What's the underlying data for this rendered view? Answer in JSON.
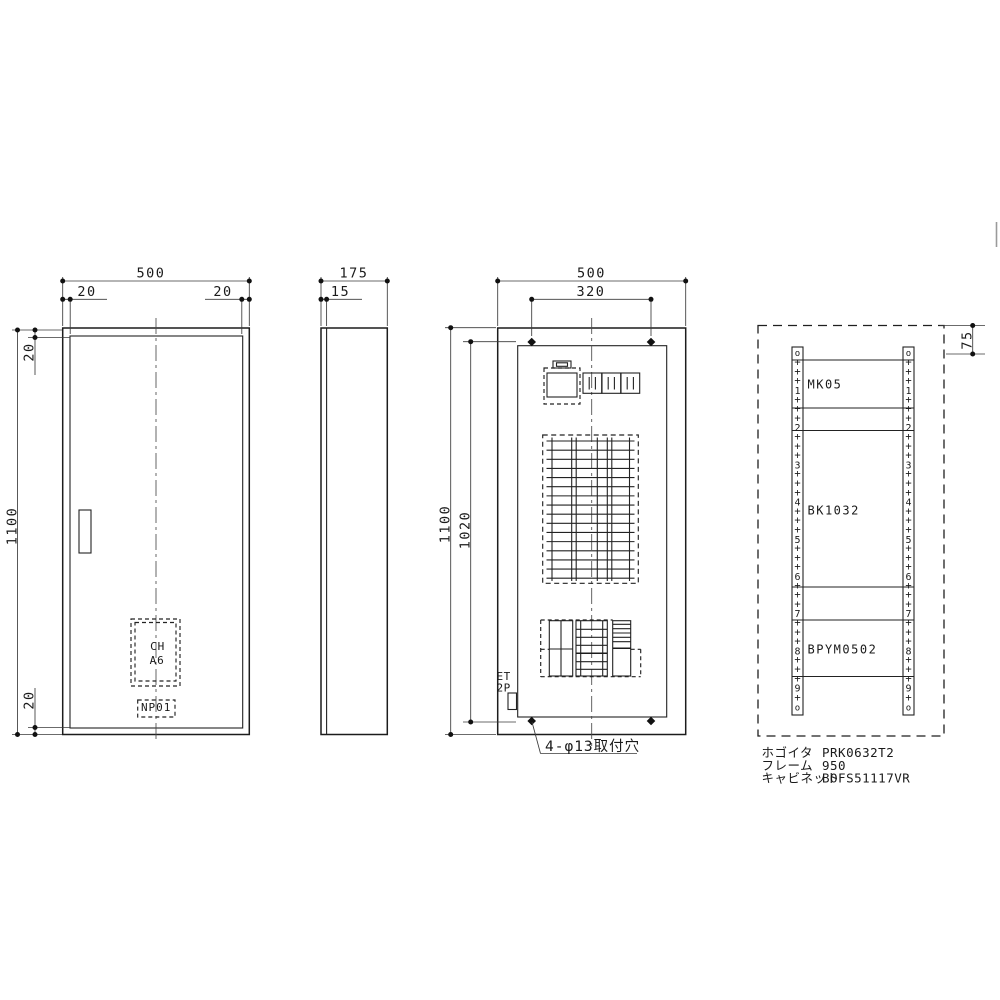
{
  "views": {
    "front": {
      "dim_width": "500",
      "dim_inset_left": "20",
      "dim_inset_right": "20",
      "dim_height": "1100",
      "dim_inset_top": "20",
      "dim_inset_bottom": "20",
      "chassis_label_top": "CH",
      "chassis_label_bottom": "A6",
      "nameplate_label": "NP01"
    },
    "side": {
      "dim_depth": "175",
      "dim_door_thickness": "15"
    },
    "internal": {
      "dim_width": "500",
      "dim_hole_pitch": "320",
      "dim_height": "1100",
      "dim_plate_height": "1020",
      "breaker_label_top": "ET",
      "breaker_label_bottom": "2P",
      "mounting_hole_note": "4-φ13取付穴"
    },
    "layout": {
      "dim_rail_top_offset": "75",
      "blocks": [
        {
          "label": "MK05"
        },
        {
          "label": "BK1032"
        },
        {
          "label": "BPYM0502"
        }
      ],
      "rail_numbers": [
        "1",
        "2",
        "3",
        "4",
        "5",
        "6",
        "7",
        "8",
        "9"
      ],
      "rail_plus_symbol": "+",
      "rail_end_symbol": "o"
    }
  },
  "spec_table": {
    "rows": [
      {
        "label": "ホゴイタ",
        "value": "PRK0632T2"
      },
      {
        "label": "フレーム",
        "value": "950"
      },
      {
        "label": "キャビネット",
        "value": "BOFS51117VR"
      }
    ]
  },
  "colors": {
    "line": "#1c1c1c",
    "background": "#ffffff"
  }
}
